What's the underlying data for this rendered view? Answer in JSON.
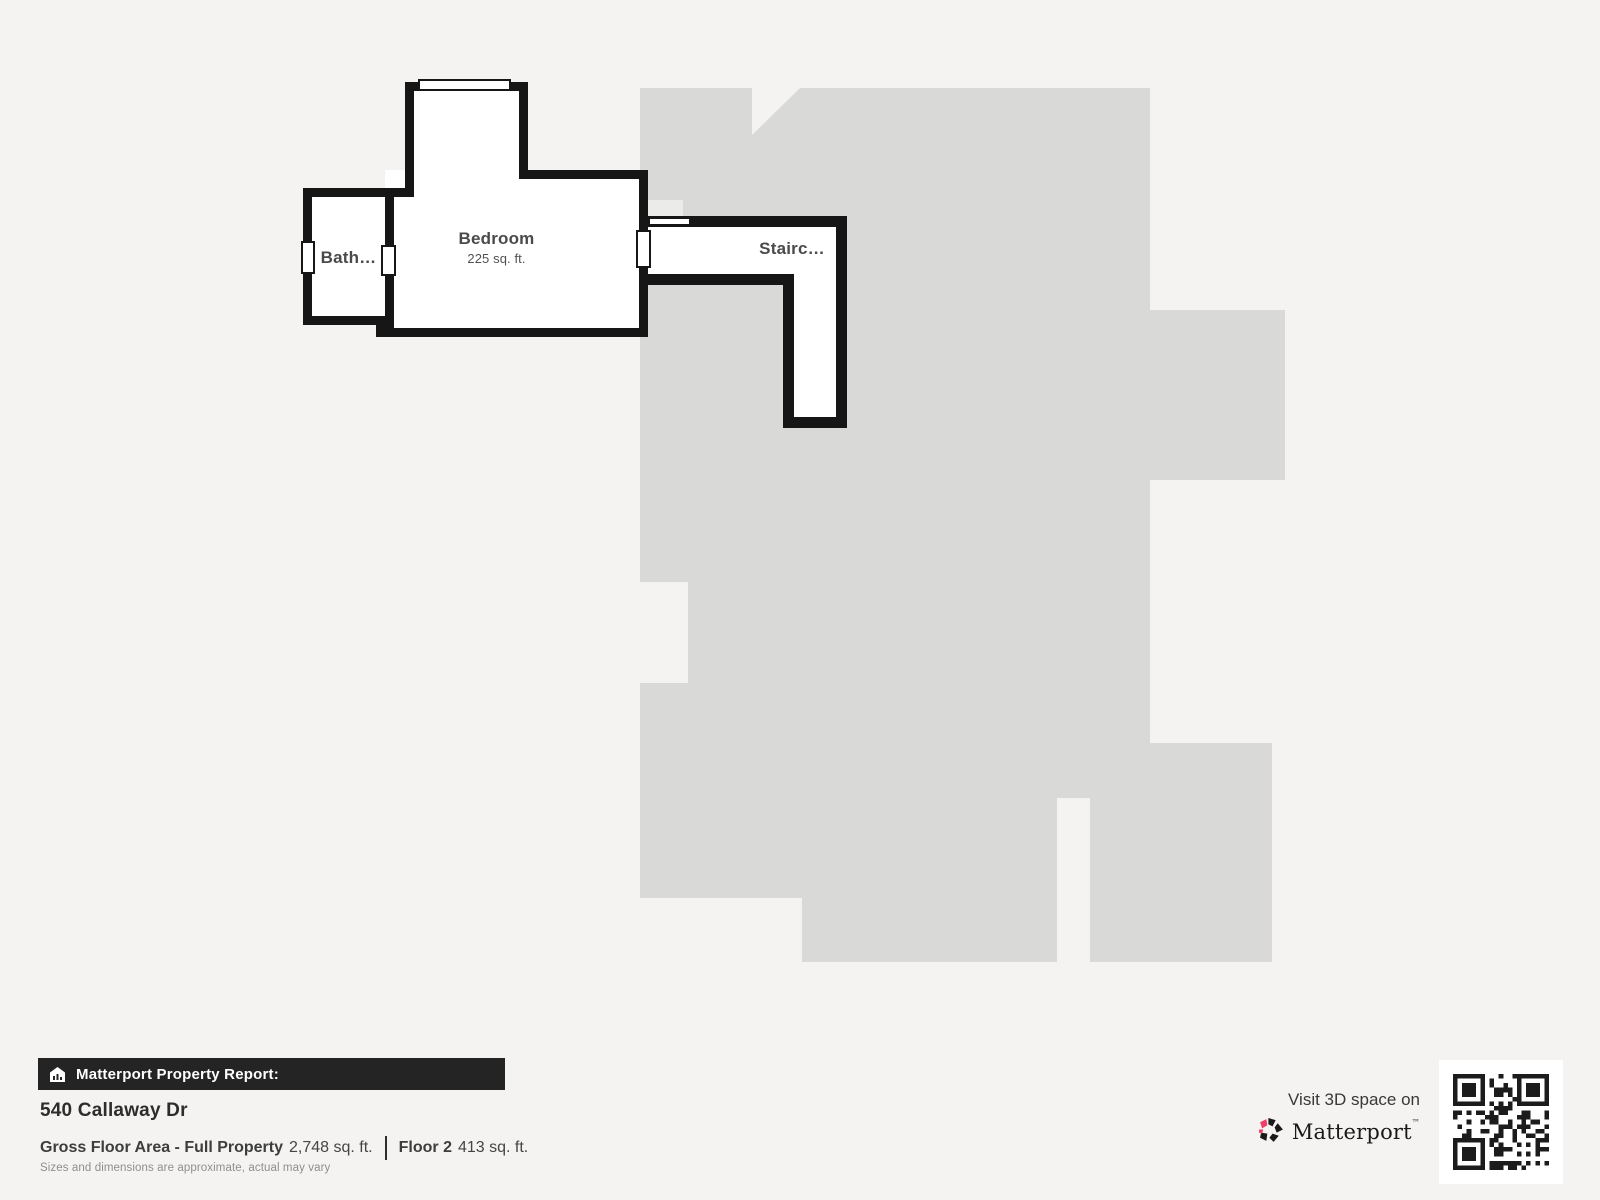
{
  "floorplan": {
    "rooms": [
      {
        "name": "Bath…"
      },
      {
        "name": "Bedroom",
        "area": "225 sq. ft."
      },
      {
        "name": "Stairc…"
      }
    ]
  },
  "report": {
    "banner": "Matterport Property Report:",
    "address": "540 Callaway Dr",
    "gross_label": "Gross Floor Area - Full Property",
    "gross_value": "2,748 sq. ft.",
    "floor_label": "Floor 2",
    "floor_value": "413 sq. ft.",
    "disclaimer": "Sizes and dimensions are approximate, actual may vary"
  },
  "promo": {
    "visit_text": "Visit 3D space on",
    "brand": "Matterport",
    "brand_mark": "™"
  },
  "colors": {
    "background": "#f4f3f1",
    "silhouette_gray": "#d9d9d7",
    "wall_black": "#161616",
    "brand_pink": "#ef3e68"
  }
}
